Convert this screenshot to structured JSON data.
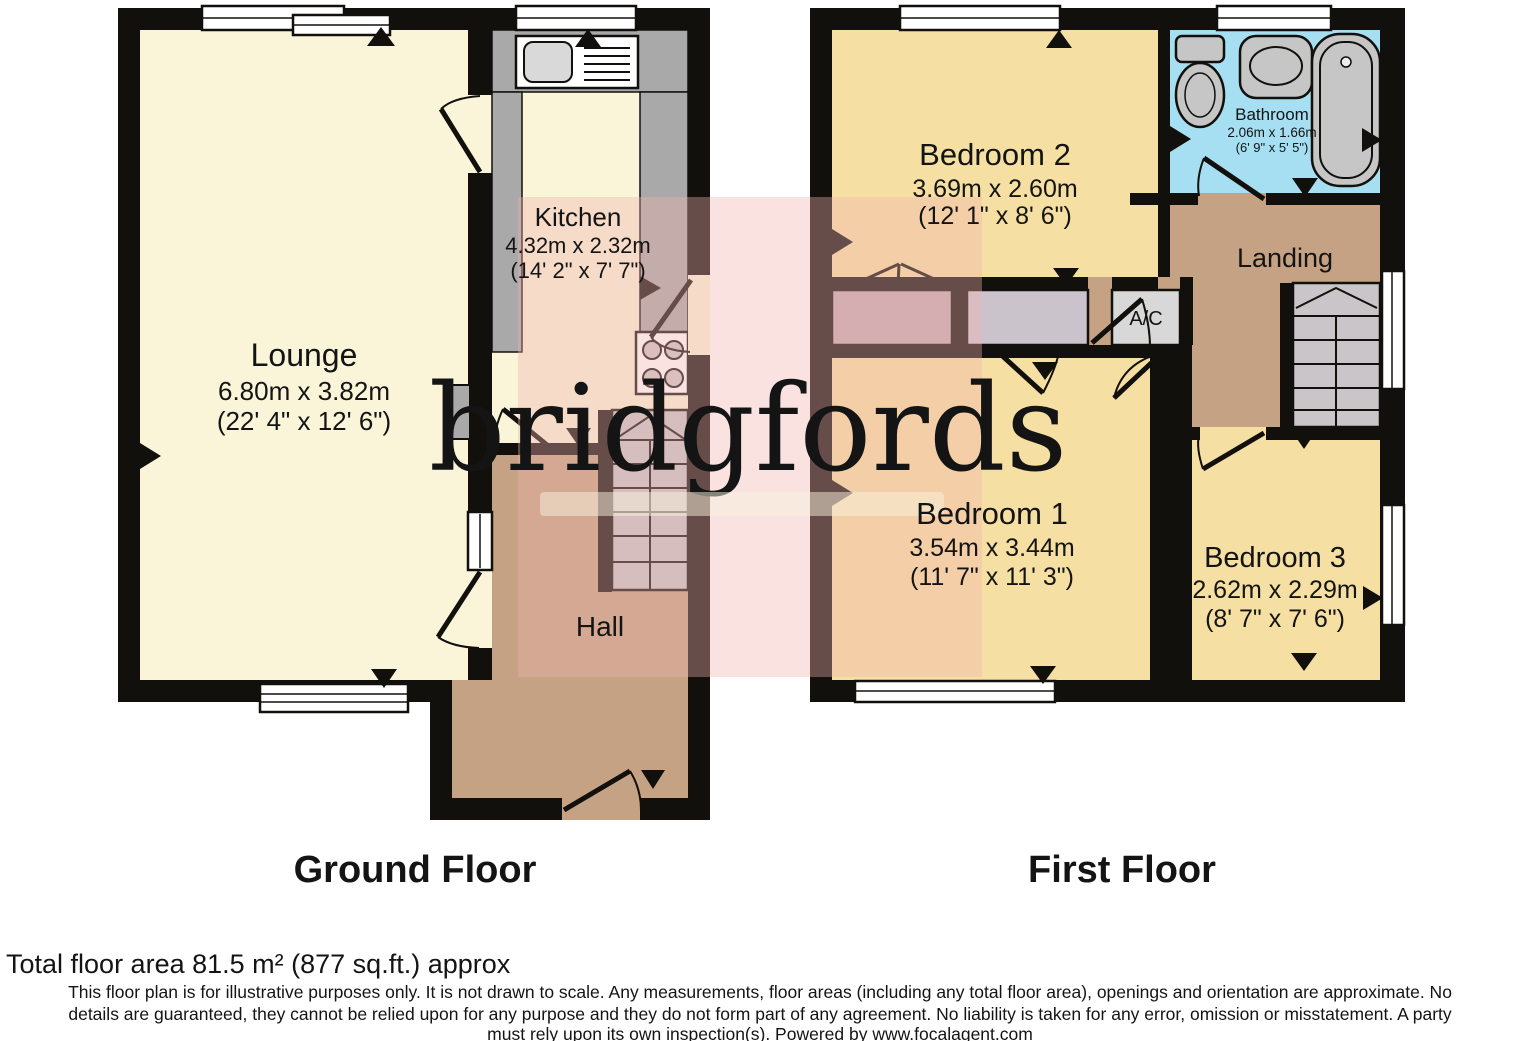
{
  "watermark": {
    "text": "bridgfords"
  },
  "floors": [
    {
      "title": "Ground Floor",
      "rooms": [
        {
          "name": "Lounge",
          "metric": "6.80m x 3.82m",
          "imperial": "(22' 4\" x 12' 6\")"
        },
        {
          "name": "Kitchen",
          "metric": "4.32m x 2.32m",
          "imperial": "(14' 2\" x 7' 7\")"
        },
        {
          "name": "Hall"
        }
      ]
    },
    {
      "title": "First Floor",
      "rooms": [
        {
          "name": "Bedroom 2",
          "metric": "3.69m x 2.60m",
          "imperial": "(12' 1\" x 8' 6\")"
        },
        {
          "name": "Bathroom",
          "metric": "2.06m x 1.66m",
          "imperial": "(6' 9\" x 5' 5\")"
        },
        {
          "name": "Landing"
        },
        {
          "name": "A/C"
        },
        {
          "name": "Bedroom 1",
          "metric": "3.54m x 3.44m",
          "imperial": "(11' 7\" x 11' 3\")"
        },
        {
          "name": "Bedroom 3",
          "metric": "2.62m x 2.29m",
          "imperial": "(8' 7\" x 7' 6\")"
        }
      ]
    }
  ],
  "footer": {
    "total_area": "Total floor area 81.5 m² (877 sq.ft.) approx",
    "disclaimer_lines": [
      "This floor plan is for illustrative purposes only. It is not drawn to scale. Any measurements, floor areas (including any total floor area), openings and orientation are approximate. No",
      "details are guaranteed, they cannot be relied upon for any purpose and they do not form part of any agreement. No liability is taken for any error, omission or misstatement. A party",
      "must rely upon its own inspection(s). Powered by www.focalagent.com"
    ]
  },
  "palette": {
    "wall": "#12100c",
    "lounge_kitchen_floor": "#faf4d9",
    "bedroom_floor": "#f5dfa2",
    "hall_landing_floor": "#c6a284",
    "bathroom_floor": "#a6dff2",
    "counter_grey": "#a9a9a9",
    "stair_grey": "#c9c5c9",
    "closet_mauve": "#c3abb2",
    "closet_grey": "#cbc3cb",
    "ac_grey": "#d8d8d8",
    "fixture_grey": "#c6c6c6",
    "watermark_pink": "rgba(238,180,173,0.38)",
    "watermark_cream": "rgba(248,241,219,0.9)"
  }
}
